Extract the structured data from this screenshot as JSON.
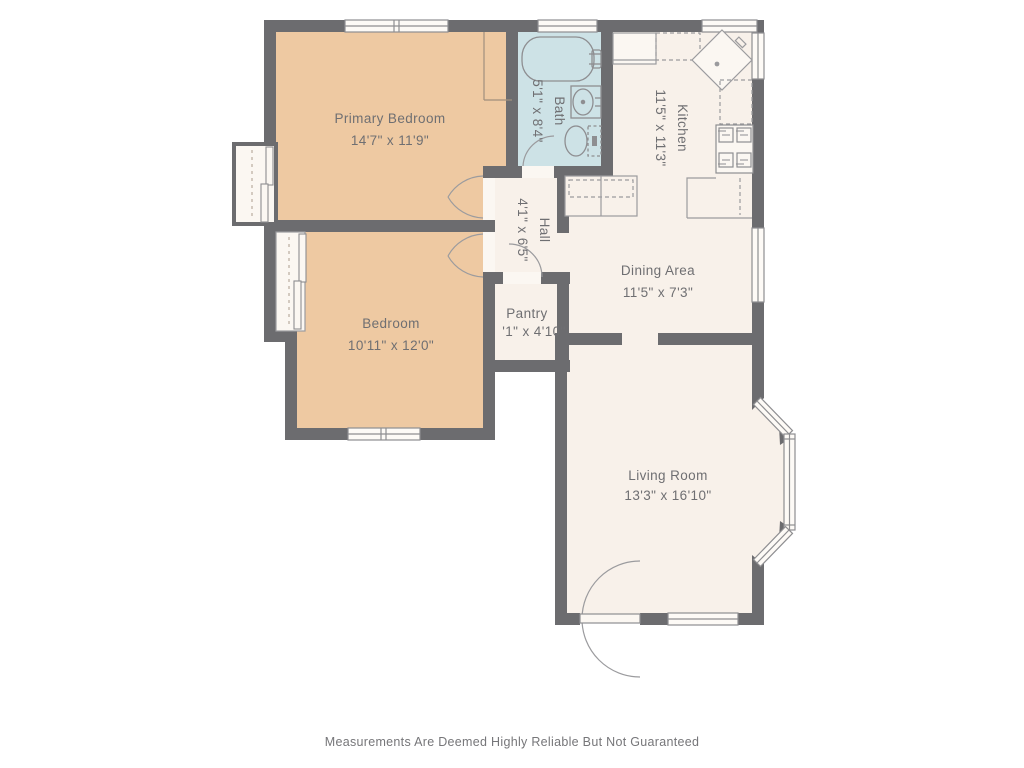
{
  "floorplan": {
    "rooms": {
      "primary_bedroom": {
        "name": "Primary Bedroom",
        "dimensions": "14'7\" x 11'9\""
      },
      "bedroom": {
        "name": "Bedroom",
        "dimensions": "10'11\" x 12'0\""
      },
      "bath": {
        "name": "Bath",
        "dimensions": "5'1\" x 8'4\""
      },
      "kitchen": {
        "name": "Kitchen",
        "dimensions": "11'5\" x 11'3\""
      },
      "hall": {
        "name": "Hall",
        "dimensions": "4'1\" x 6'5\""
      },
      "pantry": {
        "name": "Pantry",
        "dimensions": "'1\" x 4'10\""
      },
      "dining_area": {
        "name": "Dining Area",
        "dimensions": "11'5\" x 7'3\""
      },
      "living_room": {
        "name": "Living Room",
        "dimensions": "13'3\" x 16'10\""
      }
    },
    "disclaimer": "Measurements Are Deemed Highly Reliable But Not Guaranteed",
    "colors": {
      "wall": "#6c6c6f",
      "bedroom_fill": "#eec9a2",
      "bath_fill": "#cde2e6",
      "room_fill": "#f8f1ea",
      "closet_fill": "#fbf7f2",
      "fixture_line": "#8e8e91",
      "label_text": "#6f6f72",
      "disclaimer_text": "#767679"
    }
  }
}
